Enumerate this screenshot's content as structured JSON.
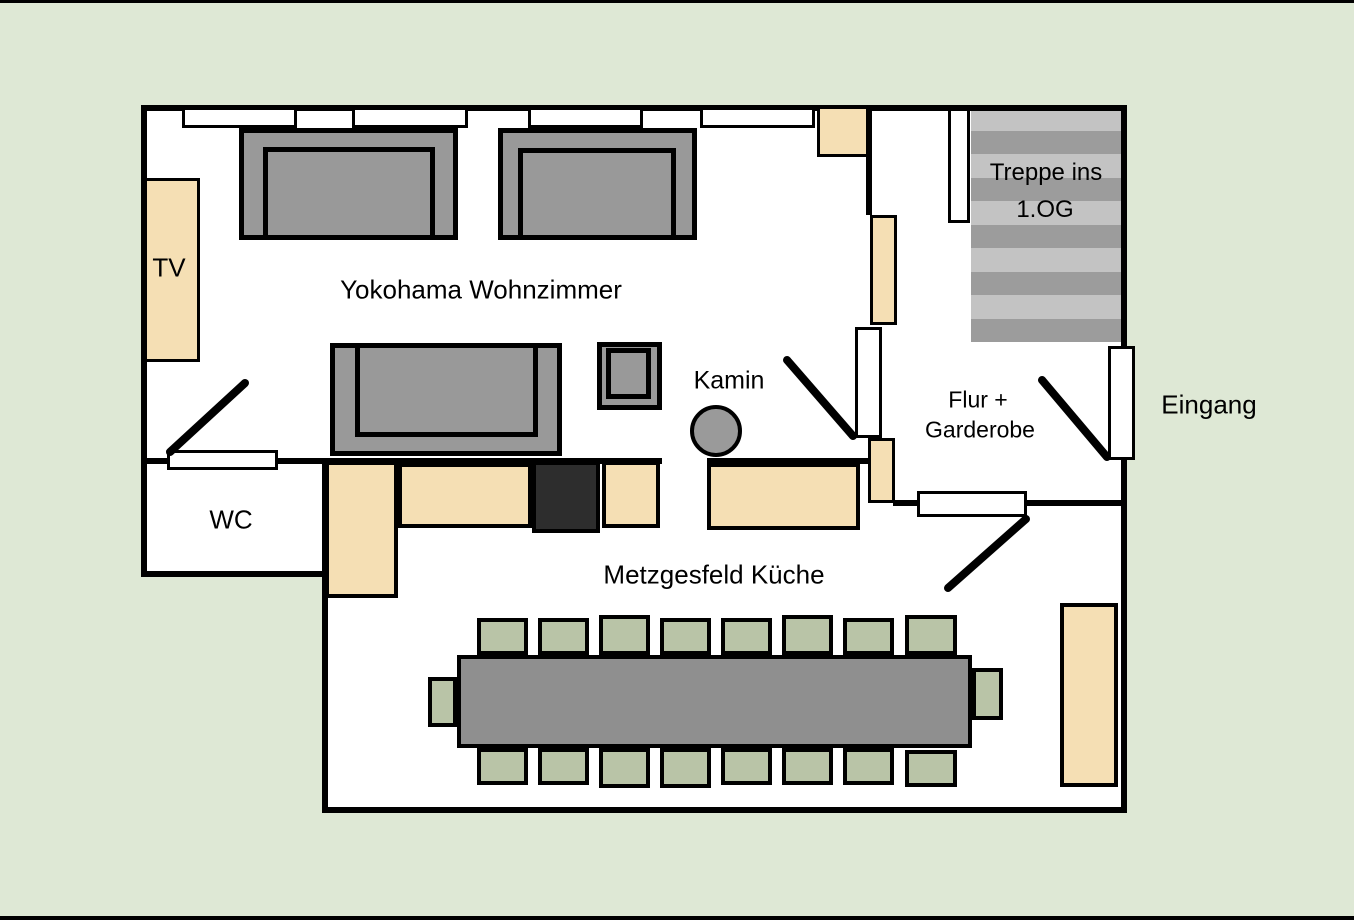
{
  "title": "Floor plan",
  "labels": {
    "tv": "TV",
    "wohnzimmer": "Yokohama Wohnzimmer",
    "kamin": "Kamin",
    "wc": "WC",
    "kueche": "Metzgesfeld Küche",
    "treppe_line1": "Treppe ins",
    "treppe_line2": "1.OG",
    "flur_line1": "Flur +",
    "flur_line2": "Garderobe",
    "eingang": "Eingang"
  },
  "colors": {
    "background": "#dee8d5",
    "floor": "#ffffff",
    "wall": "#000000",
    "furniture_gray": "#999999",
    "table_gray": "#8f8f8f",
    "counter_tan": "#f5dfb4",
    "chair_green": "#b9c4a7",
    "stair_light": "#c3c3c3",
    "stair_dark": "#9c9c9c",
    "stove_dark": "#2d2d2d",
    "kamin_gray": "#9a9a9a",
    "text": "#000000"
  },
  "counts": {
    "windows": 4,
    "doors": 5,
    "table_chairs": 18,
    "stair_steps": 10
  }
}
